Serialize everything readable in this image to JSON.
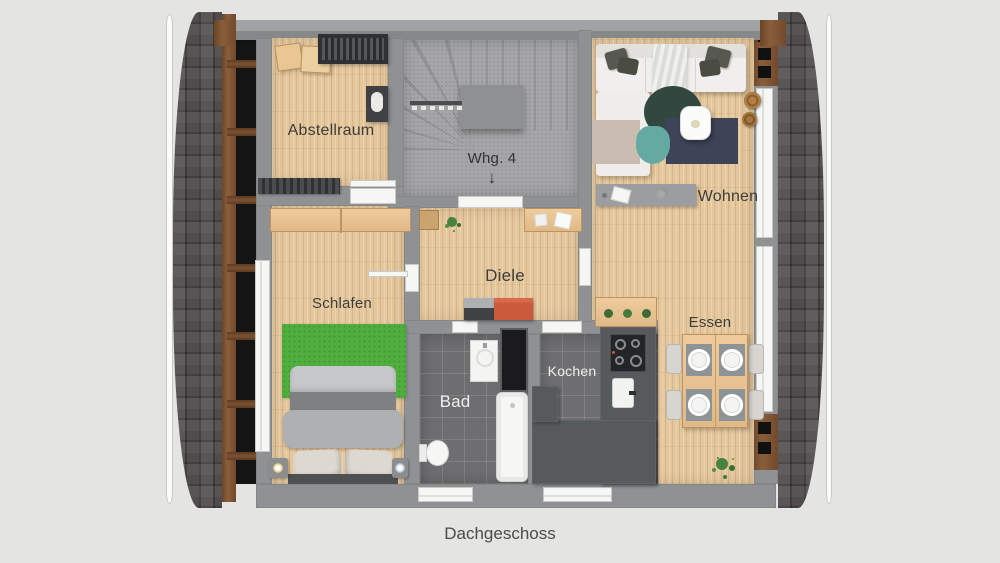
{
  "caption": "Dachgeschoss",
  "unit_label": "Whg. 4",
  "unit_arrow": "↓",
  "rooms": {
    "abstellraum": "Abstellraum",
    "schlafen": "Schlafen",
    "diele": "Diele",
    "wohnen": "Wohnen",
    "essen": "Essen",
    "kochen": "Kochen",
    "bad": "Bad"
  },
  "colors": {
    "background": "#e4e4e2",
    "wall": "#8f9193",
    "wood_floor": "#e5c79c",
    "tile_floor": "#6e6e70",
    "stair_floor": "#a6a6a8",
    "roof_shingle": "#4d494b",
    "roof_beam": "#7c5234",
    "rug_green": "#4fae3e",
    "accent_dresser": "#cb5a3c",
    "counter": "#565a5c",
    "label_dark": "#3d3d3d",
    "label_light": "#efefee"
  }
}
